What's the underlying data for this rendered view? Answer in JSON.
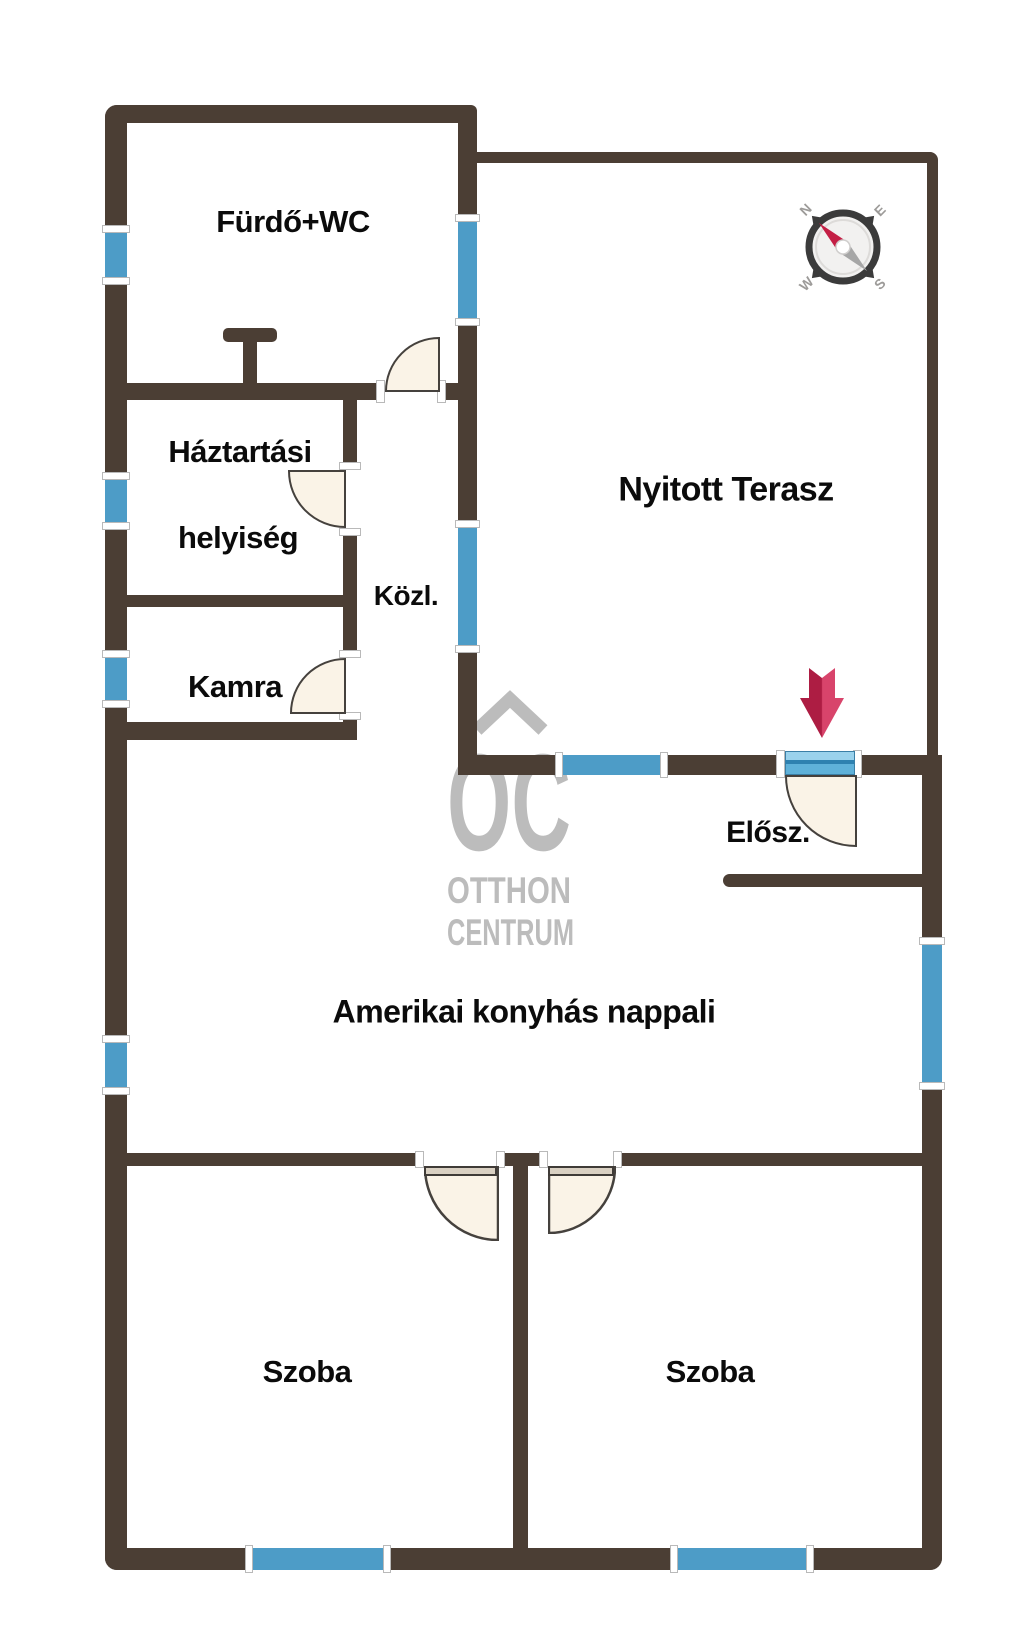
{
  "floorplan": {
    "title_labels": {
      "bathroom": "Fürdő+WC",
      "utility_line1": "Háztartási",
      "utility_line2": "helyiség",
      "corridor": "Közl.",
      "pantry": "Kamra",
      "terrace": "Nyitott Terasz",
      "entry_hall": "Elősz.",
      "living_room": "Amerikai konyhás nappali",
      "bedroom_left": "Szoba",
      "bedroom_right": "Szoba"
    },
    "watermark": {
      "logo": "OC",
      "line1": "OTTHON",
      "line2": "CENTRUM"
    },
    "compass": {
      "north": "N",
      "east": "E",
      "south": "S",
      "west": "W"
    },
    "colors": {
      "wall": "#4b3e34",
      "window": "#4d9cc7",
      "door_fill": "#faf3e7",
      "entrance_arrow": "#c42349",
      "watermark_gray": "#bcbcbc"
    }
  }
}
